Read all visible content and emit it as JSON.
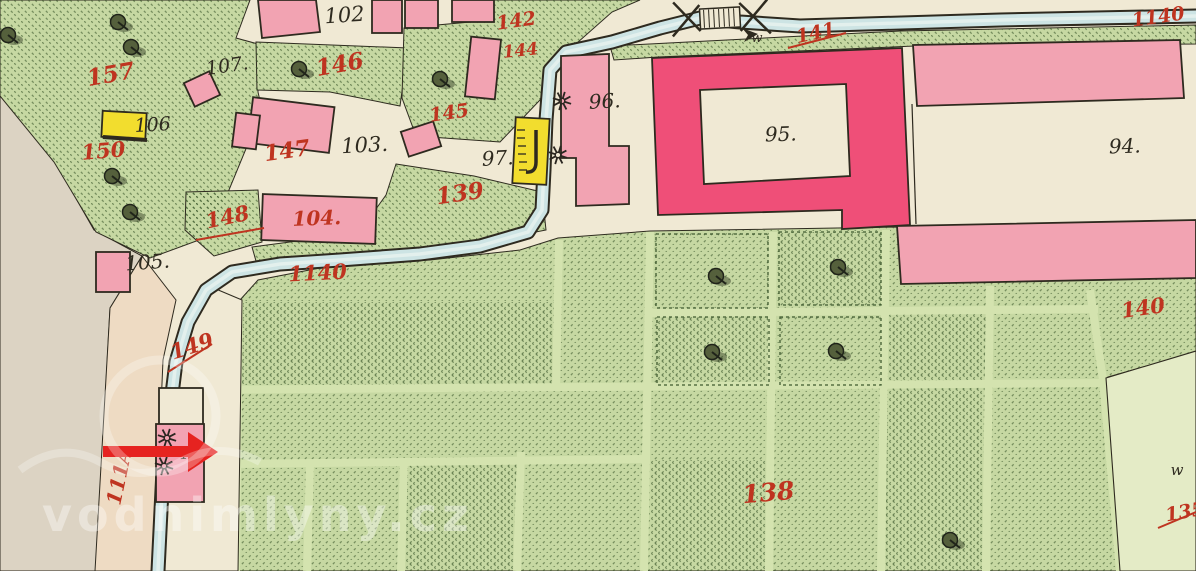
{
  "palette": {
    "paper": "#f0e9d4",
    "green": "#c6d8a2",
    "pathGreen": "#d4e3af",
    "pale": "#e4ebc6",
    "gray": "#dcd3c3",
    "tan": "#eedbc3",
    "pink": "#f2a3b2",
    "crimson": "#ef4f78",
    "yellow": "#f2dd2e",
    "stream": "#cde4e4",
    "ink": "#2e2a1f",
    "red": "#bf3420",
    "arrow": "#e62320"
  },
  "watermark": {
    "text": "vodnimlyny.cz"
  },
  "labels": [
    {
      "name": "parcel-157",
      "text": "157",
      "color": "red",
      "x": 112,
      "y": 82,
      "size": 23,
      "rot": -10
    },
    {
      "name": "parcel-150",
      "text": "150",
      "color": "red",
      "x": 104,
      "y": 158,
      "size": 21,
      "rot": -5
    },
    {
      "name": "house-106",
      "text": "106",
      "color": "black",
      "x": 153,
      "y": 131,
      "size": 19,
      "rot": -3
    },
    {
      "name": "house-107",
      "text": "107.",
      "color": "black",
      "x": 228,
      "y": 72,
      "size": 19,
      "rot": -8
    },
    {
      "name": "house-102",
      "text": "102",
      "color": "black",
      "x": 345,
      "y": 22,
      "size": 21,
      "rot": -4
    },
    {
      "name": "parcel-146",
      "text": "146",
      "color": "red",
      "x": 341,
      "y": 72,
      "size": 23,
      "rot": -10
    },
    {
      "name": "parcel-142",
      "text": "142",
      "color": "red",
      "x": 517,
      "y": 27,
      "size": 19,
      "rot": -8
    },
    {
      "name": "parcel-144",
      "text": "144",
      "color": "red",
      "x": 521,
      "y": 56,
      "size": 17,
      "rot": -6
    },
    {
      "name": "parcel-145",
      "text": "145",
      "color": "red",
      "x": 450,
      "y": 119,
      "size": 19,
      "rot": -8
    },
    {
      "name": "parcel-147",
      "text": "147",
      "color": "red",
      "x": 288,
      "y": 158,
      "size": 22,
      "rot": -8
    },
    {
      "name": "house-103",
      "text": "103.",
      "color": "black",
      "x": 365,
      "y": 152,
      "size": 21,
      "rot": -3
    },
    {
      "name": "parcel-148",
      "text": "148",
      "color": "red",
      "x": 229,
      "y": 224,
      "size": 21,
      "rot": -12
    },
    {
      "name": "parcel-104",
      "text": "104.",
      "color": "red",
      "x": 317,
      "y": 225,
      "size": 20,
      "rot": -2
    },
    {
      "name": "house-105",
      "text": "105.",
      "color": "black",
      "x": 148,
      "y": 269,
      "size": 20,
      "rot": -4
    },
    {
      "name": "house-97",
      "text": "97.",
      "color": "black",
      "x": 498,
      "y": 165,
      "size": 20,
      "rot": -3
    },
    {
      "name": "house-96",
      "text": "96.",
      "color": "black",
      "x": 605,
      "y": 108,
      "size": 20,
      "rot": -3
    },
    {
      "name": "house-95",
      "text": "95.",
      "color": "black",
      "x": 781,
      "y": 141,
      "size": 20,
      "rot": -2
    },
    {
      "name": "house-94",
      "text": "94.",
      "color": "black",
      "x": 1125,
      "y": 153,
      "size": 20,
      "rot": -2
    },
    {
      "name": "parcel-139",
      "text": "139",
      "color": "red",
      "x": 461,
      "y": 201,
      "size": 23,
      "rot": -8
    },
    {
      "name": "parcel-1140-west",
      "text": "1140",
      "color": "red",
      "x": 318,
      "y": 280,
      "size": 21,
      "rot": -3
    },
    {
      "name": "parcel-1140-northeast",
      "text": "1140",
      "color": "red",
      "x": 1159,
      "y": 23,
      "size": 19,
      "rot": -8
    },
    {
      "name": "parcel-141",
      "text": "141",
      "color": "red",
      "x": 817,
      "y": 39,
      "size": 19,
      "rot": -12
    },
    {
      "name": "parcel-149",
      "text": "149",
      "color": "red",
      "x": 194,
      "y": 353,
      "size": 21,
      "rot": -18
    },
    {
      "name": "parcel-138",
      "text": "138",
      "color": "red",
      "x": 769,
      "y": 501,
      "size": 25,
      "rot": -5
    },
    {
      "name": "parcel-140",
      "text": "140",
      "color": "red",
      "x": 1144,
      "y": 315,
      "size": 21,
      "rot": -8
    },
    {
      "name": "parcel-135",
      "text": "135",
      "color": "red",
      "x": 1186,
      "y": 518,
      "size": 19,
      "rot": -10
    },
    {
      "name": "parcel-111A",
      "text": "111A",
      "color": "red",
      "x": 126,
      "y": 478,
      "size": 20,
      "rot": -78
    },
    {
      "name": "house-116",
      "text": "116",
      "color": "black",
      "x": 194,
      "y": 458,
      "size": 15,
      "rot": -5
    },
    {
      "name": "meadow-mark-top",
      "text": "w",
      "color": "black",
      "x": 757,
      "y": 42,
      "size": 13,
      "rot": 0
    },
    {
      "name": "meadow-mark-southeast",
      "text": "w",
      "color": "black",
      "x": 1177,
      "y": 475,
      "size": 15,
      "rot": 0
    }
  ],
  "symbols": {
    "trees": [
      {
        "x": 8,
        "y": 35
      },
      {
        "x": 118,
        "y": 22
      },
      {
        "x": 131,
        "y": 47
      },
      {
        "x": 299,
        "y": 69
      },
      {
        "x": 112,
        "y": 176
      },
      {
        "x": 130,
        "y": 212
      },
      {
        "x": 440,
        "y": 79
      },
      {
        "x": 716,
        "y": 276
      },
      {
        "x": 838,
        "y": 267
      },
      {
        "x": 712,
        "y": 352
      },
      {
        "x": 836,
        "y": 351
      },
      {
        "x": 950,
        "y": 540
      }
    ],
    "waterwheels": [
      {
        "x": 562,
        "y": 101
      },
      {
        "x": 558,
        "y": 155
      },
      {
        "x": 167,
        "y": 438
      },
      {
        "x": 164,
        "y": 466
      }
    ]
  }
}
